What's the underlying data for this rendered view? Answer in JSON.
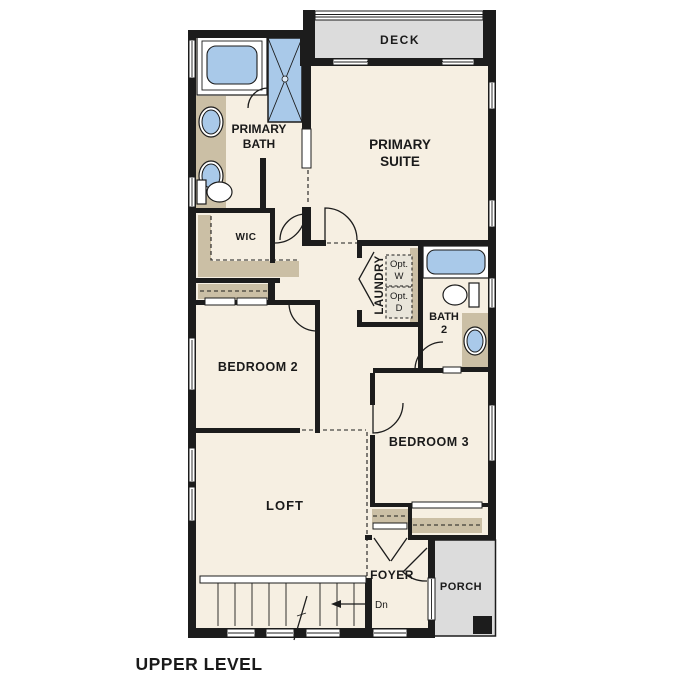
{
  "caption": "UPPER LEVEL",
  "colors": {
    "floor": "#f6efe2",
    "counter_tan": "#cbbfa5",
    "fixture_blue": "#a9c9e9",
    "deck_porch_gray": "#dcdcdc",
    "wall_black": "#1c1c1c",
    "background": "#ffffff"
  },
  "rooms": {
    "deck": {
      "label": "DECK"
    },
    "primary_suite": {
      "line1": "PRIMARY",
      "line2": "SUITE"
    },
    "primary_bath": {
      "line1": "PRIMARY",
      "line2": "BATH"
    },
    "wic": {
      "label": "WIC"
    },
    "laundry": {
      "label": "LAUNDRY",
      "washer_line1": "Opt.",
      "washer_line2": "W",
      "dryer_line1": "Opt.",
      "dryer_line2": "D"
    },
    "bath2": {
      "line1": "BATH",
      "line2": "2"
    },
    "bedroom2": {
      "label": "BEDROOM 2"
    },
    "bedroom3": {
      "label": "BEDROOM 3"
    },
    "loft": {
      "label": "LOFT"
    },
    "foyer": {
      "label": "FOYER"
    },
    "porch": {
      "label": "PORCH"
    }
  },
  "stairs": {
    "down_label": "Dn"
  }
}
